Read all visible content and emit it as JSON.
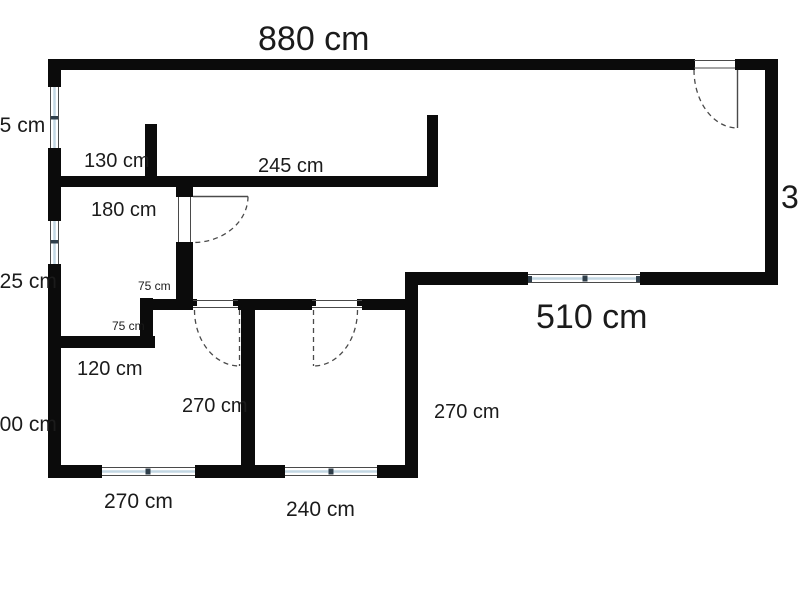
{
  "colors": {
    "background": "#ffffff",
    "wall": "#0b0b0b",
    "window_frame": "#c3d7e3",
    "window_tick": "#2f3e4a",
    "door_line": "#4a4a4a",
    "text": "#1b1b1b"
  },
  "labels": {
    "top_width": "880 cm",
    "left_upper": "65 cm",
    "left_middle": "125 cm",
    "left_lower": "300 cm",
    "hall_upper": "130 cm",
    "hall_wide": "245 cm",
    "hall_door": "180 cm",
    "jog_upper": "75 cm",
    "jog_lower": "75 cm",
    "room_small": "120 cm",
    "room_bottom_left_height": "270 cm",
    "bottom_left_width": "270 cm",
    "bottom_mid_width": "240 cm",
    "right_room_height": "270 cm",
    "living_width": "510 cm",
    "right_edge_partial": "3"
  }
}
